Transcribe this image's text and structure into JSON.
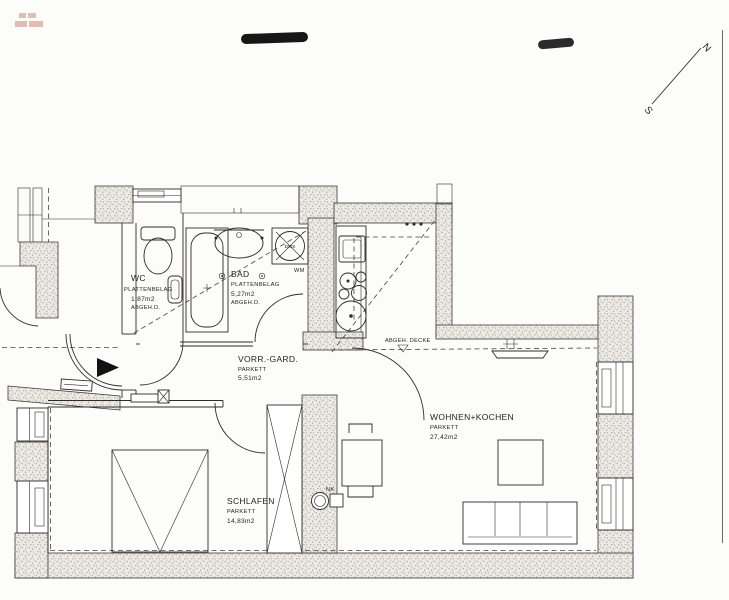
{
  "plan": {
    "rooms": [
      {
        "name": "WC",
        "floor": "PLATTENBELAG",
        "area": "1,87m2",
        "ceiling": "ABGEH.D."
      },
      {
        "name": "BAD",
        "floor": "PLATTENBELAG",
        "area": "5,27m2",
        "ceiling": "ABGEH.D."
      },
      {
        "name": "VORR.-GARD.",
        "floor": "PARKETT",
        "area": "5,51m2"
      },
      {
        "name": "WOHNEN+KOCHEN",
        "floor": "PARKETT",
        "area": "27,42m2"
      },
      {
        "name": "SCHLAFEN",
        "floor": "PARKETT",
        "area": "14,83m2"
      }
    ],
    "annotations": {
      "ceiling_note": "ABGEH. DECKE",
      "washing_machine": "WM",
      "shower_tray": "DWS",
      "niche": "NK"
    },
    "compass": {
      "north": "N",
      "south": "S"
    },
    "colors": {
      "wall_fill": "#eceae5",
      "line": "#2e2c29",
      "stamp_red": "#c0604a"
    }
  }
}
